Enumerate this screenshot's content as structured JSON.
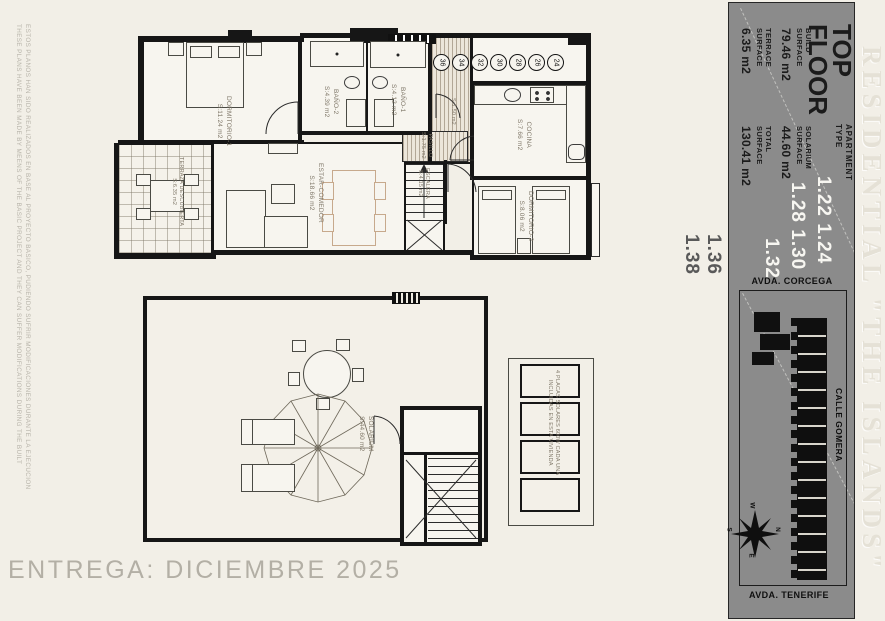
{
  "disclaimer": {
    "es": "ESTOS PLANOS HAN SIDO REALIZADOS EN BASE AL PROYECTO BASICO, PUDIENDO SUFRIR MODIFICACIONES DURANTE LA EJECUCION",
    "en": "THESE PLANS HAVE BEEN MADE BY MEENS OF THE BASIC PROJECT AND THEY CAN SUFFER MODIFICATIONS DURING THE BUILT"
  },
  "delivery": "ENTREGA: DICIEMBRE 2025",
  "watermark": "RESIDENTIAL \"THE ISLANDS\"",
  "title_block": {
    "floor1": "TOP",
    "floor2": "FLOOR",
    "apt1": "APARTMENT",
    "apt2": "TYPE",
    "build": {
      "l1": "BUILD",
      "l2": "SURFACE",
      "v": "79.46 m2"
    },
    "solarium": {
      "l1": "SOLARIUM",
      "l2": "SURFACE",
      "v": "44.60 m2"
    },
    "terrace": {
      "l1": "TERRACE",
      "l2": "SURFACE",
      "v": "6.35 m2"
    },
    "total": {
      "l1": "TOTAL",
      "l2": "SURFACE",
      "v": "130.41 m2"
    },
    "nums": {
      "r1": "1.22 1.24",
      "r2": "1.28 1.30",
      "r3": "1.32",
      "r4": "1.36",
      "r5": "1.38"
    }
  },
  "site": {
    "street_top": "AVDA. CORCEGA",
    "street_right": "CALLE GOMERA",
    "street_bottom": "AVDA. TENERIFE",
    "compass": {
      "n": "N",
      "s": "S",
      "e": "E",
      "w": "W"
    }
  },
  "window_tags": [
    "36",
    "34",
    "32",
    "30",
    "28",
    "26",
    "24"
  ],
  "colors": {
    "panel_gray": "#8b8b8b",
    "line_black": "#161616",
    "cream": "#f2efe7",
    "tan_furniture": "#c7a98c"
  },
  "upper_plan": {
    "dorm1": {
      "name": "DORMITORIO-1",
      "area": "S:11.24 m2"
    },
    "bano2": {
      "name": "BAÑO-2",
      "area": "S:4.39 m2"
    },
    "bano1": {
      "name": "BAÑO-1",
      "area": "S:4.12 m2"
    },
    "cocina": {
      "name": "COCINA",
      "area": "S:7.66 m2"
    },
    "dorm2": {
      "name": "DORMITORIO-2",
      "area": "S:8.06 m2"
    },
    "estar": {
      "name": "ESTAR-COMEDOR",
      "area": "S:18.66 m2"
    },
    "terraza": {
      "name": "TERRAZA DESCUBIERTA",
      "area": "S:6.35 m2"
    },
    "pasillo": {
      "name": "PASILLO",
      "area": "S:1.75 m2"
    },
    "escalera": {
      "name": "ESCALERA",
      "area": "S:4.15 m2"
    },
    "hall": {
      "area": "S:1.50 m2"
    }
  },
  "lower_plan": {
    "solarium": {
      "name": "SOLARIUM",
      "area": "S:44.60 m2"
    },
    "solar_note1": "4 PLACAS SOLARES 600W CADA UNA",
    "solar_note2": "INCLUIDAS EN ESTA VIVIENDA"
  }
}
